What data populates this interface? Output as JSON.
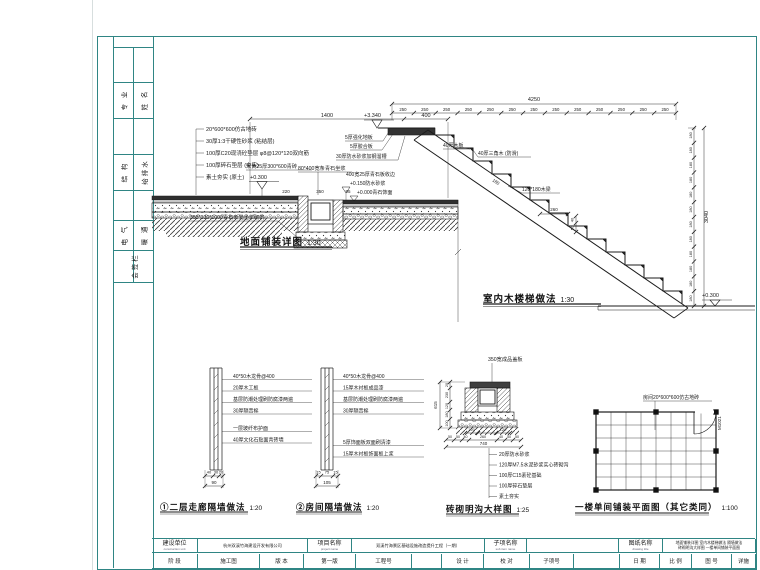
{
  "colors": {
    "frame": "#2f8584",
    "ink": "#1b1b1b",
    "paper": "#ffffff"
  },
  "sidebar": {
    "cells": [
      {
        "c1": "专 业",
        "c2": "姓 名"
      },
      {
        "c1": "结 构",
        "c2": "给排水"
      },
      {
        "c1": "电 气",
        "c2": "暖 通"
      }
    ],
    "footer": "会签栏"
  },
  "titleblock": {
    "row1": [
      {
        "t": "label",
        "cn": "建设单位",
        "en": "construction unit",
        "w": 46
      },
      {
        "t": "value",
        "cn": "杭州双溪竹海建设开发有限公司",
        "w": 110
      },
      {
        "t": "label",
        "cn": "项目名称",
        "en": "project name",
        "w": 44
      },
      {
        "t": "value",
        "cn": "双溪竹海景区基础设施改造提升工程（一期）",
        "w": 133
      },
      {
        "t": "label",
        "cn": "子项名称",
        "en": "sub item name",
        "w": 42
      },
      {
        "t": "value",
        "cn": "",
        "w": 92
      },
      {
        "t": "label",
        "cn": "图纸名称",
        "en": "drawing title",
        "w": 44
      },
      {
        "t": "value2",
        "l1": "地面铺装详图 室内木楼梯做法 隔墙做法",
        "l2": "砖砌明沟大样图 一楼单间铺装平面图",
        "w": 93
      }
    ],
    "row2": [
      {
        "cn": "阶 段",
        "w": 46
      },
      {
        "cn": "施工图",
        "w": 62
      },
      {
        "cn": "版 本",
        "w": 44
      },
      {
        "cn": "第一版",
        "w": 52
      },
      {
        "cn": "工程号",
        "w": 56
      },
      {
        "cn": "",
        "w": 30
      },
      {
        "cn": "设 计",
        "w": 42
      },
      {
        "cn": "校 对",
        "w": 46
      },
      {
        "cn": "子项号",
        "w": 44
      },
      {
        "cn": "",
        "w": 46
      },
      {
        "cn": "日 期",
        "w": 40
      },
      {
        "cn": "比 例",
        "w": 32
      },
      {
        "cn": "图 号",
        "w": 40
      },
      {
        "cn": "详施",
        "w": 24
      }
    ]
  },
  "details": {
    "paving": {
      "title": "地面铺装详图",
      "scale": "1:30",
      "notes": [
        "20*600*600仿古地砖",
        "30厚1:3干硬性砂浆 (粘结层)",
        "100厚C20现浇砼垫层 φ8@120*120双向筋",
        "100厚碎石垫层 (夯实)",
        "素土夯实 (原土)"
      ],
      "dim1": "1400",
      "dim2": "400",
      "stone": "米黄25厚300*600青砖",
      "elev1": "+0.300",
      "curb": "80*400宽条青石坐浆",
      "edge": "400宽25厚青石板收边",
      "elev2": "+0.150防水砂浆",
      "elev3": "+0.000青石饰面",
      "dims_mid": [
        "220",
        "350",
        "95"
      ],
      "bottom": "355*130*1000青石条凳坐浆砌筑"
    },
    "stair": {
      "title": "室内木楼梯做法",
      "scale": "1:30",
      "elev_top": "+3.340",
      "elev_bottom": "+0.300",
      "top_total": "4250",
      "top_seg": "250",
      "top_count": 13,
      "right_total": "3040",
      "right_seg": "180",
      "right_count": 12,
      "notes": [
        "5厚强化地板",
        "5厚胶合板",
        "30厚防水砂浆加钢溜槽"
      ],
      "tread": "40厚木板",
      "nosing": "40厚三角木 (防滑)",
      "beam": "120*180木梁",
      "dim_mid": "260",
      "dim_v1": "40",
      "dim_v2": "50",
      "dim_diag": "180"
    },
    "wall1": {
      "no": "①",
      "title": "①二层走廊隔墙做法",
      "scale": "1:20",
      "notes": [
        "40*50木龙骨@400",
        "20厚木工板",
        "基层防潮处理刷防腐漆两遍",
        "30厚隔音棉",
        "一层玻纤布护面",
        "40厚文化石贴面青砖墙"
      ],
      "dims": [
        "40",
        "30",
        "20"
      ],
      "dim_total": "90"
    },
    "wall2": {
      "no": "②",
      "title": "②房间隔墙做法",
      "scale": "1:20",
      "notes": [
        "40*50木龙骨@400",
        "15厚木衬板成品漆",
        "基层防潮处理刷防腐漆两遍",
        "30厚隔音棉",
        "5厚饰面板双面刷清漆",
        "15厚木衬板饰面板上浆"
      ],
      "dims": [
        "15",
        "75",
        "15"
      ],
      "dim_total": "105"
    },
    "gutter": {
      "title": "砖砌明沟大样图",
      "scale": "1:25",
      "label_top": "350宽成品盖板",
      "dims_left": [
        "20",
        "230",
        "120",
        "180",
        "100"
      ],
      "dim_left_total": "615",
      "dims_upper": [
        "120",
        "120"
      ],
      "dims_bottom": [
        "50",
        "50",
        "40",
        "260",
        "40",
        "50",
        "50"
      ],
      "dim_bottom_total": "740",
      "notes": [
        "20厚防水砂浆",
        "120厚M7.5水泥砂浆实心砖砌沟",
        "100厚C15素砼基础",
        "100厚碎石垫层",
        "素土夯实"
      ]
    },
    "plan": {
      "title": "一楼单间铺装平面图（其它类同）",
      "scale": "1:100",
      "label": "房间20*600*600仿古地砖",
      "door": "M1021",
      "cols": 8,
      "rows": 6
    }
  }
}
